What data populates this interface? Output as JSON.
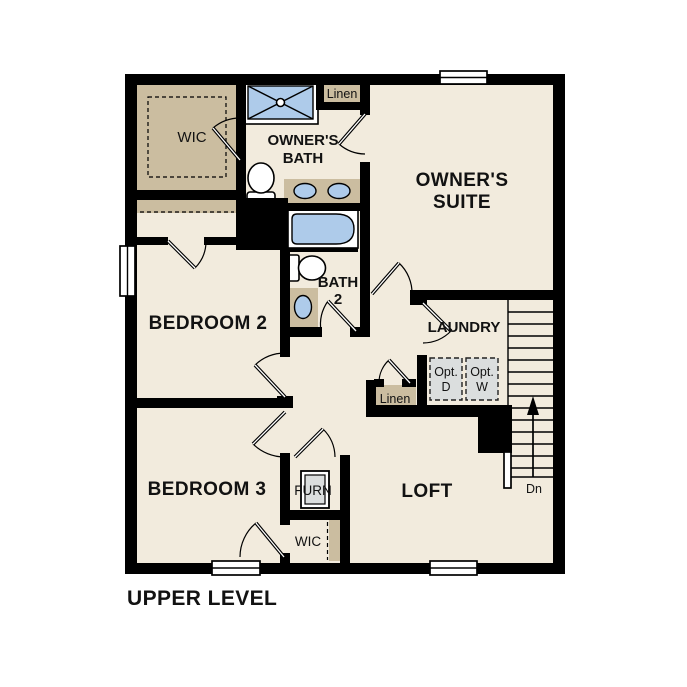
{
  "title": "UPPER LEVEL",
  "rooms": {
    "wic_upper": {
      "label": "WIC"
    },
    "owners_bath": {
      "line1": "OWNER'S",
      "line2": "BATH"
    },
    "linen_upper": {
      "label": "Linen"
    },
    "owners_suite": {
      "line1": "OWNER'S",
      "line2": "SUITE"
    },
    "bedroom_2": {
      "label": "BEDROOM 2"
    },
    "bath_2": {
      "line1": "BATH",
      "line2": "2"
    },
    "laundry": {
      "label": "LAUNDRY"
    },
    "optional_dryer": {
      "line1": "Opt.",
      "line2": "D"
    },
    "optional_washer": {
      "line1": "Opt.",
      "line2": "W"
    },
    "linen_lower": {
      "label": "Linen"
    },
    "bedroom_3": {
      "label": "BEDROOM 3"
    },
    "furnace": {
      "label": "FURN"
    },
    "loft": {
      "label": "LOFT"
    },
    "wic_lower": {
      "label": "WIC"
    },
    "stairs": {
      "direction_label": "Dn"
    }
  },
  "colors": {
    "floor": "#F2EBDD",
    "closet_tan": "#CBBDA0",
    "fixture_blue": "#AECBEA",
    "optional_gray": "#DBDEDE",
    "wall": "#000000",
    "background": "#FFFFFF"
  }
}
